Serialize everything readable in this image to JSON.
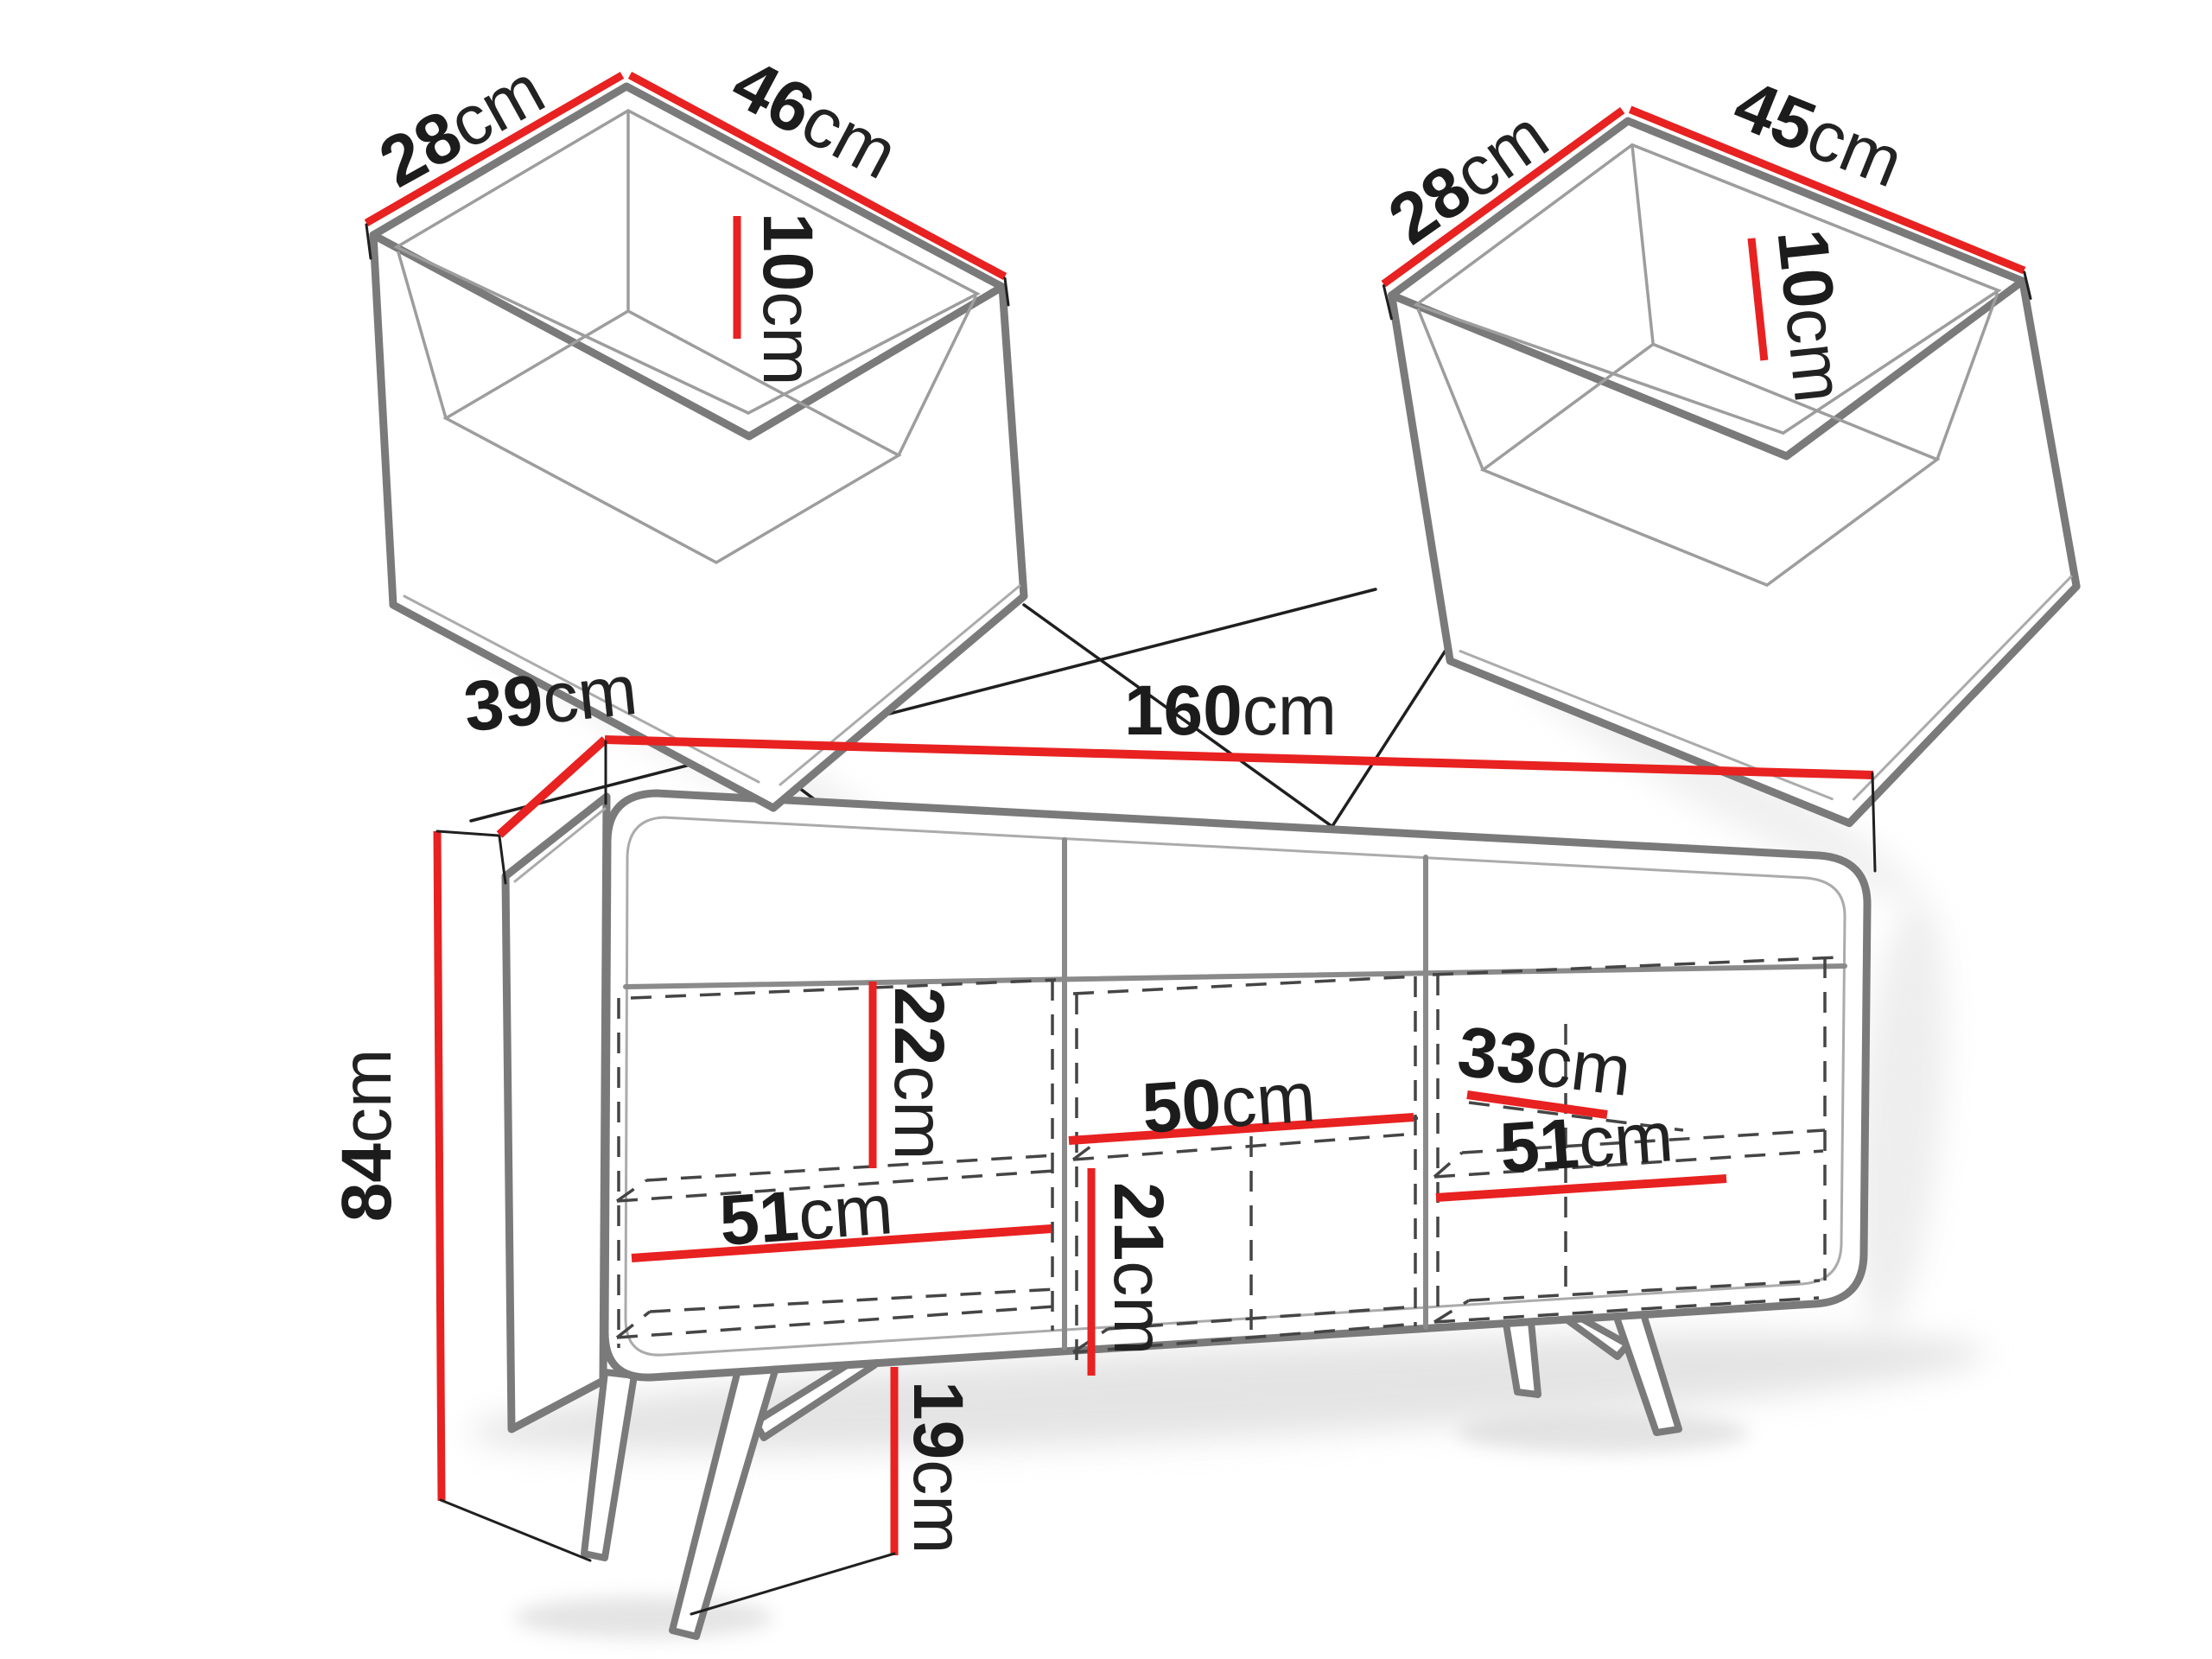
{
  "meta": {
    "type": "furniture-dimension-diagram",
    "subject": "sideboard with two drawers",
    "unit_system": "cm"
  },
  "colors": {
    "dimension_red": "#e82121",
    "outline_gray": "#7a7a7a",
    "leader_black": "#1f1f1f",
    "background": "#ffffff"
  },
  "dimensions": {
    "left_drawer_width": {
      "value": "28",
      "unit": "cm"
    },
    "left_drawer_depth": {
      "value": "46",
      "unit": "cm"
    },
    "left_drawer_height": {
      "value": "10",
      "unit": "cm"
    },
    "right_drawer_width": {
      "value": "28",
      "unit": "cm"
    },
    "right_drawer_depth": {
      "value": "45",
      "unit": "cm"
    },
    "right_drawer_height": {
      "value": "10",
      "unit": "cm"
    },
    "cabinet_depth": {
      "value": "39",
      "unit": "cm"
    },
    "cabinet_width": {
      "value": "160",
      "unit": "cm"
    },
    "cabinet_height": {
      "value": "84",
      "unit": "cm"
    },
    "left_compartment_top_height": {
      "value": "22",
      "unit": "cm"
    },
    "left_compartment_width": {
      "value": "51",
      "unit": "cm"
    },
    "middle_shelf_width": {
      "value": "50",
      "unit": "cm"
    },
    "middle_compartment_height": {
      "value": "21",
      "unit": "cm"
    },
    "right_shelf_depth": {
      "value": "33",
      "unit": "cm"
    },
    "right_compartment_width": {
      "value": "51",
      "unit": "cm"
    },
    "leg_height": {
      "value": "19",
      "unit": "cm"
    }
  }
}
